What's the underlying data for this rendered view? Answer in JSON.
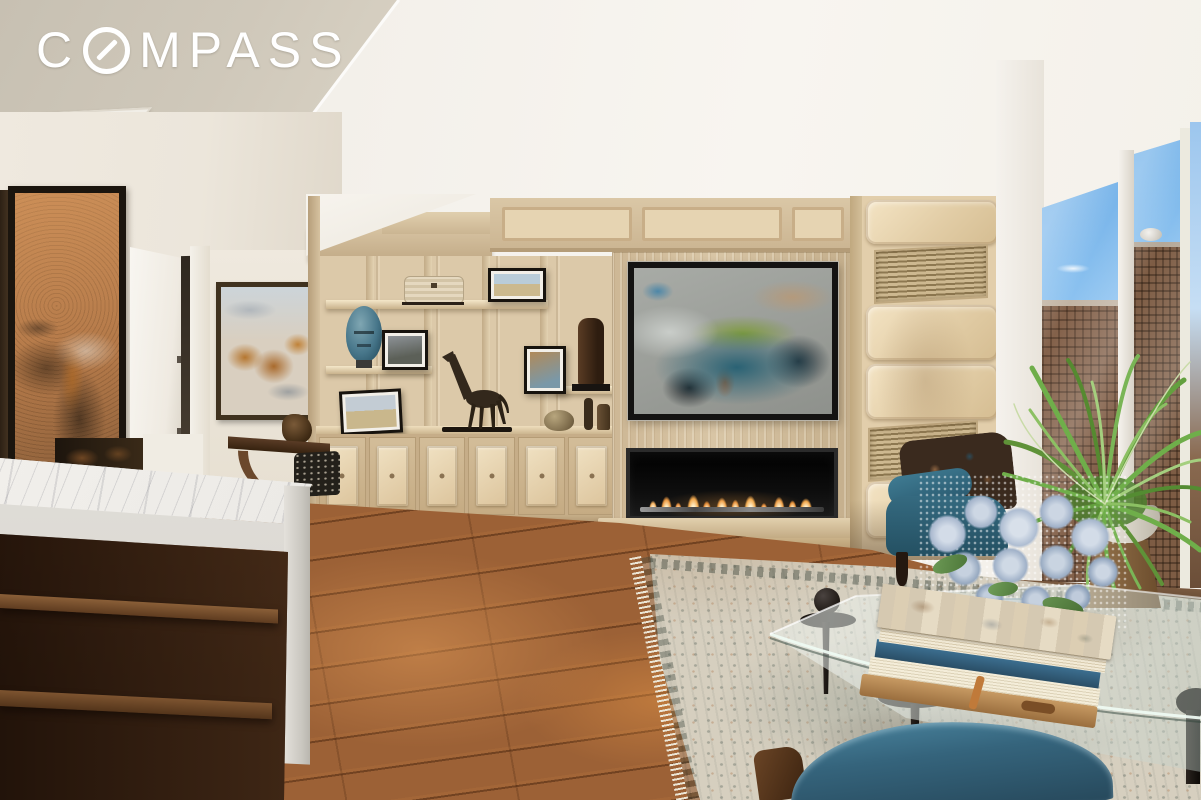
{
  "watermark": {
    "brand": "COMPASS",
    "logo_prefix": "C",
    "logo_suffix": "MPASS"
  },
  "colors": {
    "brand-white": "#ffffff",
    "ceiling": "#f4f1eb",
    "soffit": "#c7c0b2",
    "wall": "#efe9df",
    "cabinetry": "#d5c1a0",
    "leather": "#ecdcbe",
    "surround": "#cdb998",
    "flame": "#f0a64c",
    "firebox": "#0d0d0d",
    "art-copper": "#bd8352",
    "art-teal": "#2a6274",
    "sky": "#76b3e9",
    "building": "#83614a",
    "floor": "#9c6136",
    "rug": "#d6cfbf",
    "marble": "#efede9",
    "walnut": "#4a2e1a",
    "chair-teal": "#35647c",
    "plant": "#6fae4a",
    "flower": "#bac6d8",
    "table-leg": "#1d1712"
  }
}
